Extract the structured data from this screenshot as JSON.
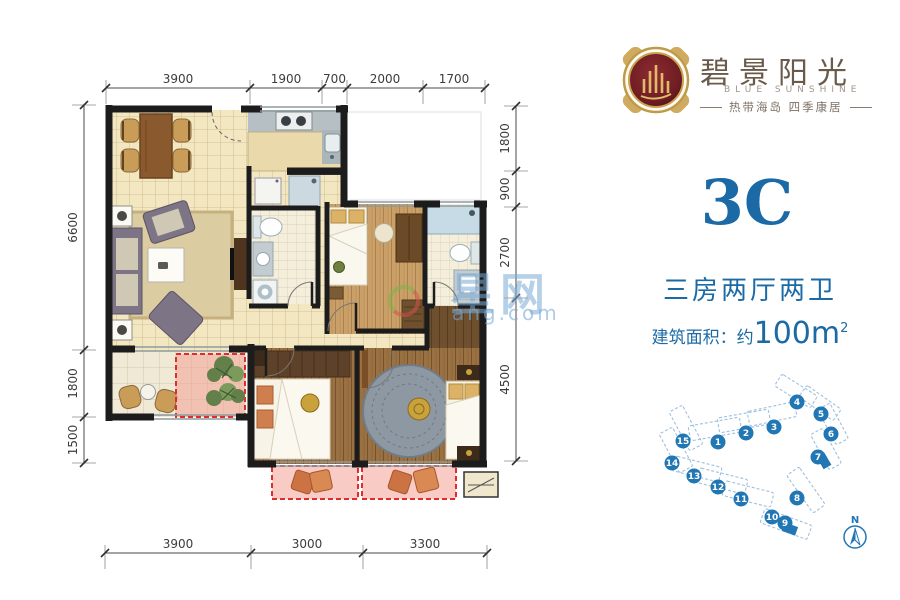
{
  "page": {
    "bg": "#ffffff"
  },
  "brand": {
    "cn": "碧景阳光",
    "en": "BLUE SUNSHINE",
    "tagline": "热带海岛  四季康居"
  },
  "unit": {
    "code": "3C",
    "rooms": "三房两厅两卫",
    "area_prefix": "建筑面积：约",
    "area_value": "100m",
    "area_sup": "2"
  },
  "watermark": {
    "big": "星网",
    "small": "ang.com"
  },
  "colors": {
    "accent_blue": "#1b6aa6",
    "site_blue": "#2176b4",
    "dash_red": "#e02c2c",
    "wall": "#1c1c1c",
    "medallion_red": "#7e242b",
    "gold": "#c9a14e"
  },
  "dims": {
    "top": {
      "axis": "x",
      "line": 88,
      "bounds": [
        106,
        250,
        322,
        347,
        423,
        485
      ],
      "labels": [
        "3900",
        "1900",
        "700",
        "2000",
        "1700"
      ]
    },
    "left": {
      "axis": "y",
      "line": 84,
      "bounds": [
        105,
        350,
        417,
        463
      ],
      "labels": [
        "6600",
        "1800",
        "1500"
      ]
    },
    "right": {
      "axis": "y",
      "line": 516,
      "bounds": [
        106,
        171,
        207,
        298,
        461
      ],
      "labels": [
        "1800",
        "900",
        "2700",
        "4500"
      ]
    },
    "bottom": {
      "axis": "x",
      "line": 553,
      "bounds": [
        105,
        251,
        363,
        487
      ],
      "labels": [
        "3900",
        "3000",
        "3300"
      ]
    }
  },
  "siteplan": {
    "compass_label": "N",
    "units": [
      {
        "n": "1",
        "x": 718,
        "y": 442
      },
      {
        "n": "2",
        "x": 746,
        "y": 433
      },
      {
        "n": "3",
        "x": 774,
        "y": 427
      },
      {
        "n": "4",
        "x": 797,
        "y": 402
      },
      {
        "n": "5",
        "x": 821,
        "y": 414
      },
      {
        "n": "6",
        "x": 831,
        "y": 434
      },
      {
        "n": "7",
        "x": 818,
        "y": 457
      },
      {
        "n": "8",
        "x": 797,
        "y": 498
      },
      {
        "n": "9",
        "x": 785,
        "y": 523
      },
      {
        "n": "10",
        "x": 772,
        "y": 517
      },
      {
        "n": "11",
        "x": 741,
        "y": 499
      },
      {
        "n": "12",
        "x": 718,
        "y": 487
      },
      {
        "n": "13",
        "x": 694,
        "y": 476
      },
      {
        "n": "14",
        "x": 672,
        "y": 463
      },
      {
        "n": "15",
        "x": 683,
        "y": 441
      }
    ],
    "highlights": [
      {
        "x": 824,
        "y": 461,
        "r": 60
      },
      {
        "x": 790,
        "y": 529,
        "r": 20
      }
    ],
    "buildings": [
      {
        "x": 715,
        "y": 429,
        "w": 52,
        "h": 15,
        "r": -10
      },
      {
        "x": 744,
        "y": 421,
        "w": 52,
        "h": 15,
        "r": -10
      },
      {
        "x": 772,
        "y": 414,
        "w": 48,
        "h": 15,
        "r": -12
      },
      {
        "x": 796,
        "y": 391,
        "w": 42,
        "h": 14,
        "r": 32
      },
      {
        "x": 820,
        "y": 403,
        "w": 42,
        "h": 14,
        "r": 35
      },
      {
        "x": 833,
        "y": 424,
        "w": 40,
        "h": 14,
        "r": 62
      },
      {
        "x": 826,
        "y": 449,
        "w": 40,
        "h": 14,
        "r": 62
      },
      {
        "x": 806,
        "y": 490,
        "w": 46,
        "h": 15,
        "r": 55
      },
      {
        "x": 786,
        "y": 524,
        "w": 50,
        "h": 15,
        "r": 20
      },
      {
        "x": 748,
        "y": 494,
        "w": 50,
        "h": 15,
        "r": 14
      },
      {
        "x": 722,
        "y": 481,
        "w": 50,
        "h": 15,
        "r": 14
      },
      {
        "x": 697,
        "y": 469,
        "w": 48,
        "h": 15,
        "r": 14
      },
      {
        "x": 676,
        "y": 450,
        "w": 44,
        "h": 15,
        "r": 62
      },
      {
        "x": 686,
        "y": 428,
        "w": 44,
        "h": 15,
        "r": 62
      }
    ]
  }
}
